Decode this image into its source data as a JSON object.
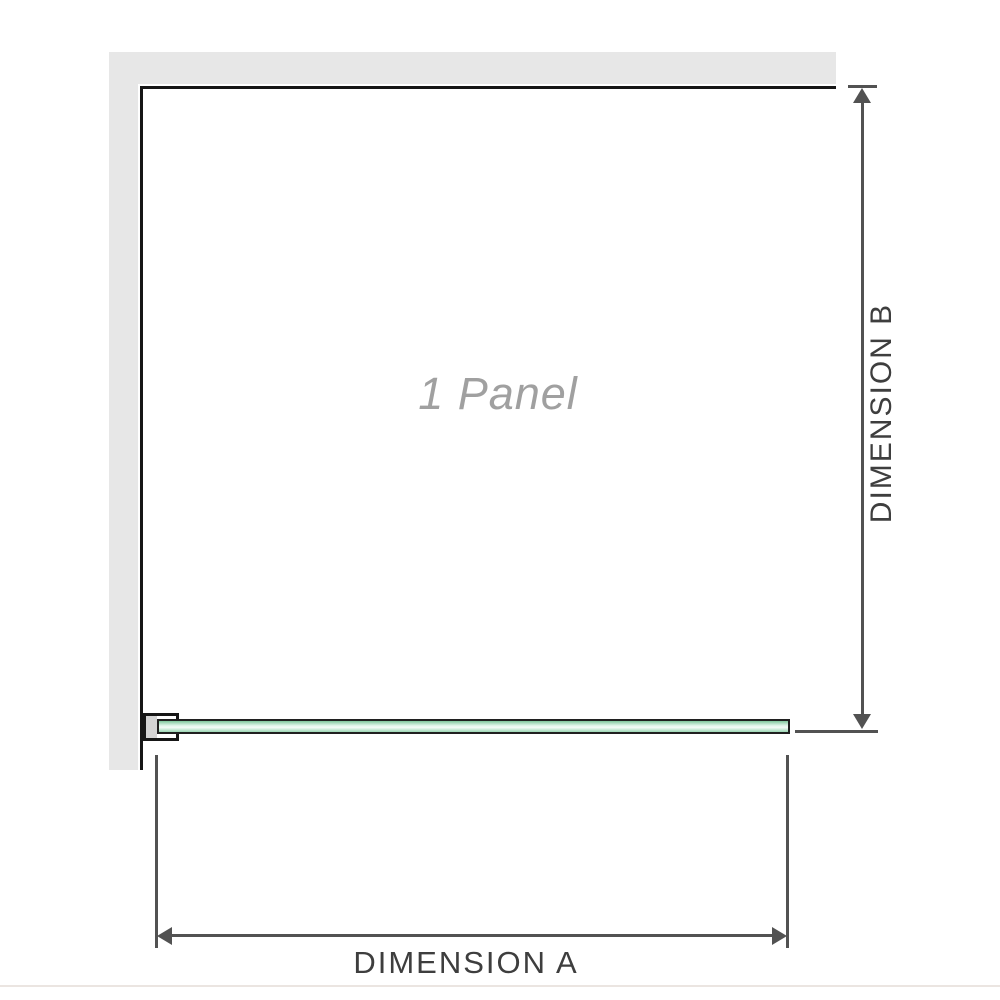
{
  "diagram": {
    "panel_label": "1 Panel",
    "dimension_a_label": "DIMENSION A",
    "dimension_b_label": "DIMENSION B"
  },
  "colors": {
    "wall": "#e7e7e7",
    "outline": "#161616",
    "dim": "#525252",
    "dim-text": "#3e3e3e",
    "panel-text": "#a0a0a0",
    "glass-border": "#202020",
    "glass-top": "#7ec69b",
    "glass-mid": "#def4e8",
    "glass-light": "#f5fcf8",
    "glass-bottom": "#9bd7b4",
    "bracket-fill": "#d4d4d4",
    "bottom-rule": "#ebe5e1"
  }
}
